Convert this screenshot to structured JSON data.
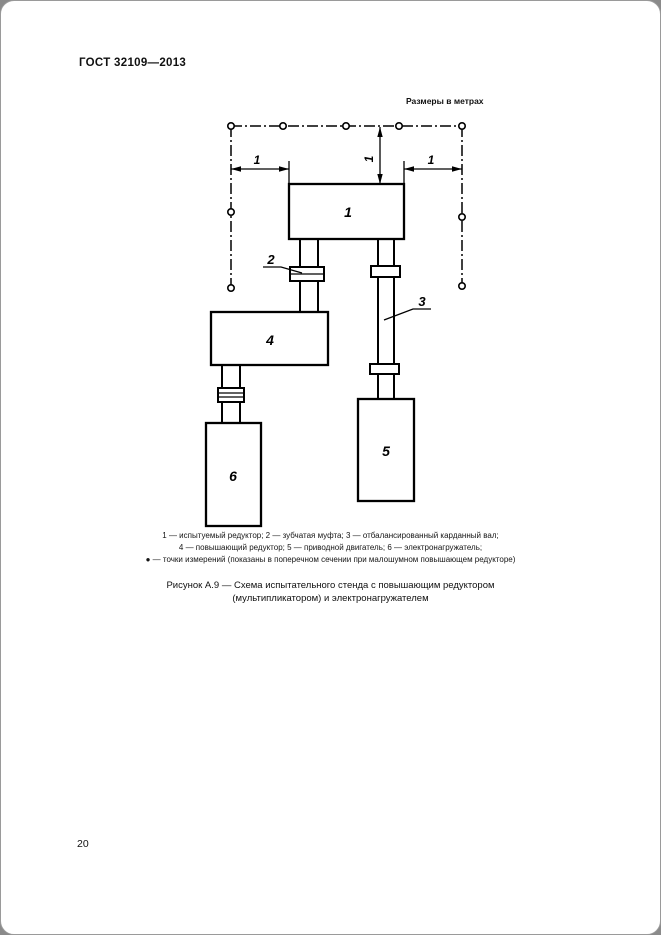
{
  "page": {
    "header": "ГОСТ 32109—2013",
    "page_number": "20"
  },
  "figure": {
    "units_note": "Размеры в метрах",
    "labels": {
      "block_1": "1",
      "coupling_2": "2",
      "shaft_3": "3",
      "block_4": "4",
      "block_5": "5",
      "block_6": "6",
      "dim_left": "1",
      "dim_vertical": "1",
      "dim_right": "1"
    },
    "legend_lines": [
      "1 — испытуемый редуктор; 2 — зубчатая муфта; 3 — отбалансированный карданный вал;",
      "4 — повышающий редуктор; 5 — приводной двигатель; 6 — электронагружатель;",
      "● — точки измерений (показаны в поперечном сечении при малошумном повышающем редукторе)"
    ],
    "caption": {
      "line1": "Рисунок А.9 — Схема испытательного стенда с повышающим редуктором",
      "line2": "(мультипликатором) и электронагружателем"
    }
  },
  "colors": {
    "ink": "#000000",
    "paper": "#ffffff",
    "scan_edge": "#8a8a8a"
  }
}
